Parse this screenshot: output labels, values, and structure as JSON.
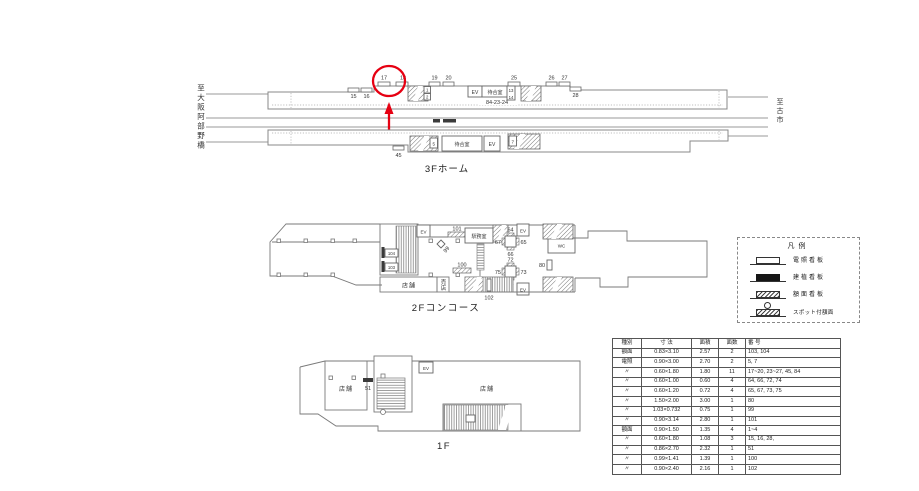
{
  "p3f": {
    "title": "3Fホーム",
    "dest_left": "至大阪阿部野橋",
    "dest_right": "至古市",
    "labels": {
      "n1": "1",
      "n2": "2",
      "n5": "5",
      "n7": "7",
      "n13": "13",
      "n14": "14",
      "n15": "15",
      "n16": "16",
      "n17": "17",
      "n18": "18",
      "n19": "19",
      "n20": "20",
      "n25": "25",
      "n26": "26",
      "n27": "27",
      "n28": "28",
      "n45": "45",
      "n84": "84-23-24",
      "ev1": "EV",
      "ev2": "EV",
      "waiting1": "待合室",
      "waiting2": "待合室"
    }
  },
  "p2f": {
    "title": "2Fコンコース",
    "labels": {
      "n64": "64",
      "n65": "65",
      "n66": "66",
      "n67": "67",
      "n72": "72",
      "n73": "73",
      "n74": "74",
      "n75": "75",
      "n80": "80",
      "n99": "99",
      "n100": "100",
      "n101": "101",
      "n102": "102",
      "n103": "103",
      "n104": "104",
      "ev_tl": "EV",
      "ev_t": "EV",
      "ev_b": "EV",
      "office": "駅務室",
      "shop": "店舗",
      "kiosk": "売店",
      "wc": "WC"
    }
  },
  "p1f": {
    "title": "1F",
    "labels": {
      "shop_left": "店舗",
      "shop_right": "店舗",
      "n51": "51",
      "ev": "EV"
    }
  },
  "legend": {
    "title": "凡例",
    "items": [
      {
        "label": "電照看板",
        "symbol": "illuminated-sign"
      },
      {
        "label": "建植看板",
        "symbol": "ground-sign"
      },
      {
        "label": "額面看板",
        "symbol": "face-sign"
      },
      {
        "label": "スポット付額面",
        "symbol": "spotlight-face-sign"
      }
    ]
  },
  "table": {
    "headers": [
      "種別",
      "寸 法",
      "面積",
      "面数",
      "番 号"
    ],
    "rows": [
      [
        "額面",
        "0.83×3.10",
        "2.57",
        "2",
        "103, 104"
      ],
      [
        "電照",
        "0.90×3.00",
        "2.70",
        "2",
        "5, 7"
      ],
      [
        "〃",
        "0.60×1.80",
        "1.80",
        "11",
        "17~20, 23~27, 45, 84"
      ],
      [
        "〃",
        "0.60×1.00",
        "0.60",
        "4",
        "64, 66, 72, 74"
      ],
      [
        "〃",
        "0.60×1.20",
        "0.72",
        "4",
        "65, 67, 73, 75"
      ],
      [
        "〃",
        "1.50×2.00",
        "3.00",
        "1",
        "80"
      ],
      [
        "〃",
        "1.03×0.732",
        "0.75",
        "1",
        "99"
      ],
      [
        "〃",
        "0.90×3.14",
        "2.80",
        "1",
        "101"
      ],
      [
        "額面",
        "0.90×1.50",
        "1.35",
        "4",
        "1~4"
      ],
      [
        "〃",
        "0.60×1.80",
        "1.08",
        "3",
        "15, 16, 28,"
      ],
      [
        "〃",
        "0.86×2.70",
        "2.32",
        "1",
        "51"
      ],
      [
        "〃",
        "0.99×1.41",
        "1.39",
        "1",
        "100"
      ],
      [
        "〃",
        "0.90×2.40",
        "2.16",
        "1",
        "102"
      ]
    ]
  },
  "colors": {
    "highlight": "#e60012",
    "outline": "#888888",
    "sign_dark": "#3a3a3a"
  }
}
